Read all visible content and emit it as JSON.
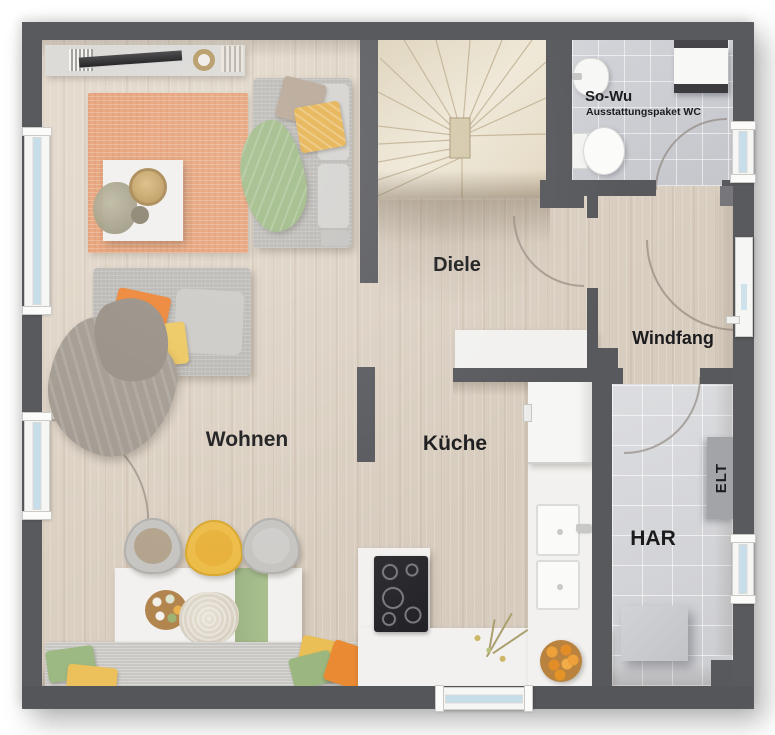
{
  "rooms": {
    "wohnen": {
      "label": "Wohnen"
    },
    "diele": {
      "label": "Diele"
    },
    "kueche": {
      "label": "Küche"
    },
    "windfang": {
      "label": "Windfang"
    },
    "har": {
      "label": "HAR"
    },
    "wc": {
      "label": "So-Wu",
      "sublabel": "Ausstattungspaket WC"
    }
  },
  "annotations": {
    "elt": {
      "label": "ELT"
    }
  },
  "colors": {
    "wall": "#595a5e",
    "floor_wood": "#d9cec0",
    "floor_tile_wc": "#c9cbd1",
    "floor_tile_har": "#d5d6da",
    "rug_orange": "#e6a076",
    "accent_green": "#9cb883",
    "accent_yellow": "#e9bb4f",
    "accent_orange": "#ec8a33",
    "window_glass": "#c7dde9",
    "counter_white": "#f2f1ef",
    "sofa_gray": "#b8b6b2",
    "stair_wood": "#e7dfcd"
  }
}
